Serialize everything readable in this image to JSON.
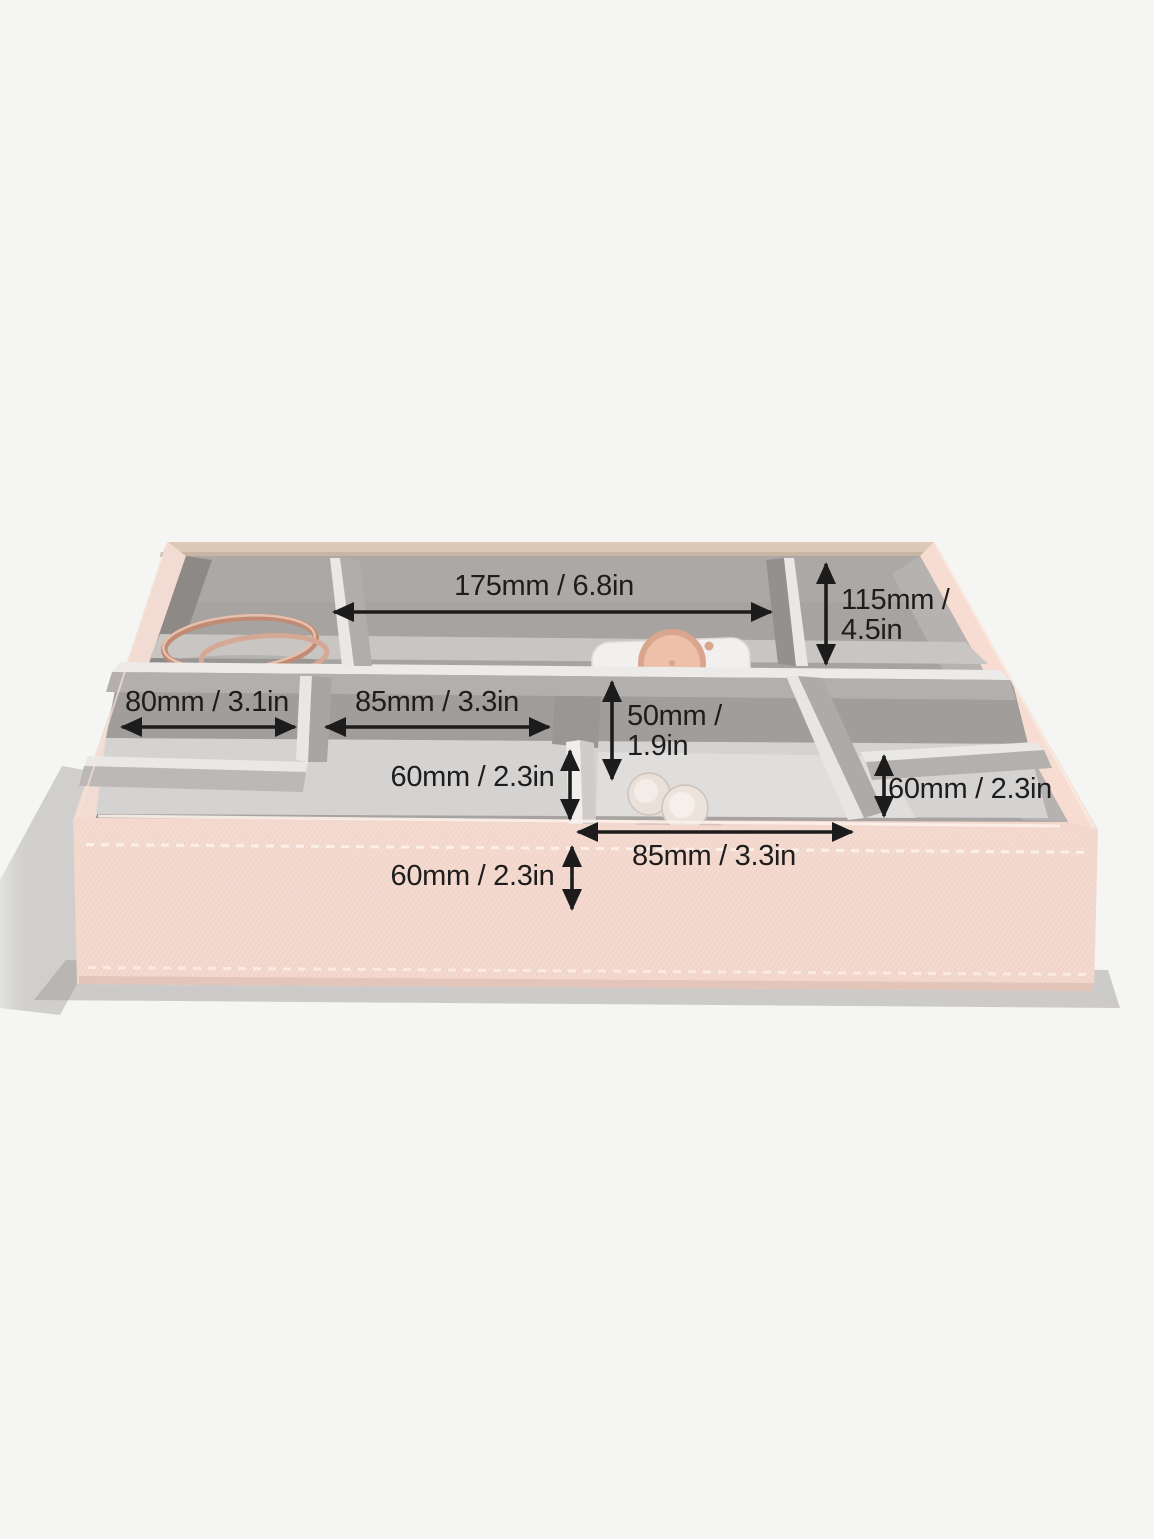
{
  "scene": {
    "background_color": "#f5f5f4",
    "product": "jewelry-organizer-tray",
    "items_visible": [
      "bangle",
      "watch",
      "cufflinks"
    ]
  },
  "tray": {
    "body_color": "#f3d7cc",
    "rim_back_color": "#ddc9b8",
    "velvet_color": "#a7a3a0",
    "divider_edge_color": "#eae8e6",
    "floor_color": "#d5d3d1"
  },
  "annotations": {
    "arrow_color": "#1c1c1c",
    "text_color": "#1d1d1d",
    "labels": [
      {
        "id": "back-inner-width",
        "text": "175mm / 6.8in",
        "orientation": "horizontal"
      },
      {
        "id": "right-inner-depth",
        "text": "115mm / 4.5in",
        "orientation": "vertical"
      },
      {
        "id": "left-section-width",
        "text": "80mm / 3.1in",
        "orientation": "horizontal"
      },
      {
        "id": "mid-section-width",
        "text": "85mm / 3.3in",
        "orientation": "horizontal"
      },
      {
        "id": "mid-section-depth",
        "text": "50mm / 1.9in",
        "orientation": "vertical"
      },
      {
        "id": "mid-divider-height",
        "text": "60mm / 2.3in",
        "orientation": "vertical"
      },
      {
        "id": "right-section-depth",
        "text": "60mm / 2.3in",
        "orientation": "vertical"
      },
      {
        "id": "front-section-width",
        "text": "85mm / 3.3in",
        "orientation": "horizontal"
      },
      {
        "id": "tray-front-height",
        "text": "60mm / 2.3in",
        "orientation": "vertical"
      }
    ]
  }
}
